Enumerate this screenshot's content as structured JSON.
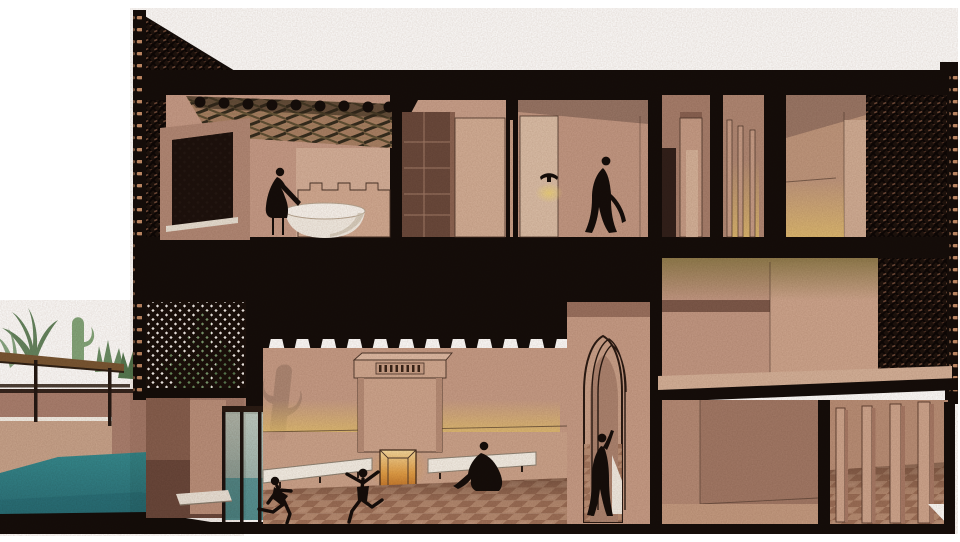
{
  "meta": {
    "title": "Sectional perspective illustration of a two-storey courtyard house",
    "style": "watercolour / textured architectural section, no text labels",
    "canvas": {
      "width": 960,
      "height": 542
    }
  },
  "colors": {
    "paper": "#ffffff",
    "ink": "#150d09",
    "wallLight": "#d9b6a0",
    "wallMid": "#c49a85",
    "wallShade": "#ab8170",
    "wallDark": "#8c6353",
    "wallDeep": "#6f4c3f",
    "cream": "#f6f2ea",
    "pool": "#2f7e85",
    "poolDeep": "#266a72",
    "glow": "#e6c46c",
    "olive": "#8e7b4a",
    "fire": "#dd9a3f",
    "fireLight": "#f5d695",
    "wood": "#7a5733",
    "woodDark": "#3f2d1c",
    "leaf": "#74996f",
    "leafDark": "#55794f",
    "cactus": "#85a87c",
    "beamDark": "#352c1d",
    "brick": "#c58f6a",
    "floorA": "#b88e74",
    "floorB": "#9e7159",
    "line": "#4a3428",
    "glass": "#a9bcb4"
  },
  "scene": {
    "building": {
      "storeys": 2,
      "cut_walls": "solid black poché with clay-brick ties along both cut edges",
      "screens": "perforated brick lattice (mashrabiya) at top-left gable, left courtyard wall and right facade"
    },
    "upper_floor_rooms": [
      {
        "name": "bathroom",
        "features": [
          "sloped timber-lattice ceiling with beam ends",
          "lattice window",
          "crenellated parapet",
          "white oval bathtub",
          "figure leaning over tub"
        ]
      },
      {
        "name": "closet-room",
        "features": [
          "dark wardrobe with shelves",
          "light door panel"
        ]
      },
      {
        "name": "sconce-room",
        "features": [
          "wall sconce with warm glow",
          "walking robed figure"
        ]
      },
      {
        "name": "wardrobe-room",
        "features": [
          "dark doorway",
          "tall cabinet pillar"
        ]
      },
      {
        "name": "slatted-room",
        "features": [
          "thin vertical partitions",
          "warm light between slats"
        ]
      },
      {
        "name": "corner-room",
        "features": [
          "ceiling corner",
          "warm light at floor"
        ]
      }
    ],
    "lower_floor_rooms": [
      {
        "name": "main-hall",
        "features": [
          "fireplace with slatted cornice and ember glow",
          "two white benches",
          "yellow light band on wall",
          "checkered tile floor",
          "two playing children",
          "seated robed figure",
          "cactus shadow on wall"
        ]
      },
      {
        "name": "arch-passage",
        "features": [
          "pointed moorish arch with receding ribs",
          "standing figure with raised arm",
          "white light triangle on tiles"
        ]
      },
      {
        "name": "mezzanine-room",
        "features": [
          "olive-yellow clerestory glow",
          "floor slab"
        ]
      },
      {
        "name": "lower-right-rooms",
        "features": [
          "vertical post partitions",
          "checkered tile floor"
        ]
      }
    ],
    "outdoor": {
      "pool": "teal water in foreground left",
      "pergola": "flat timber canopy on slender posts",
      "plants": [
        "palm fronds",
        "saguaro cactus",
        "desert shrubs",
        "cacti behind brick screen"
      ]
    },
    "figures": [
      {
        "name": "bather",
        "pose": "leaning over bathtub",
        "location": "upper bathroom"
      },
      {
        "name": "walker",
        "pose": "striding in long robe",
        "location": "upper sconce-room"
      },
      {
        "name": "greeter",
        "pose": "standing, arm raised",
        "location": "arch passage"
      },
      {
        "name": "sitter",
        "pose": "seated cross-legged on bench",
        "location": "main hall"
      },
      {
        "name": "child-skipping",
        "pose": "skipping forward",
        "location": "main hall floor"
      },
      {
        "name": "child-leaping",
        "pose": "leaping, arms spread",
        "location": "main hall floor"
      }
    ]
  }
}
